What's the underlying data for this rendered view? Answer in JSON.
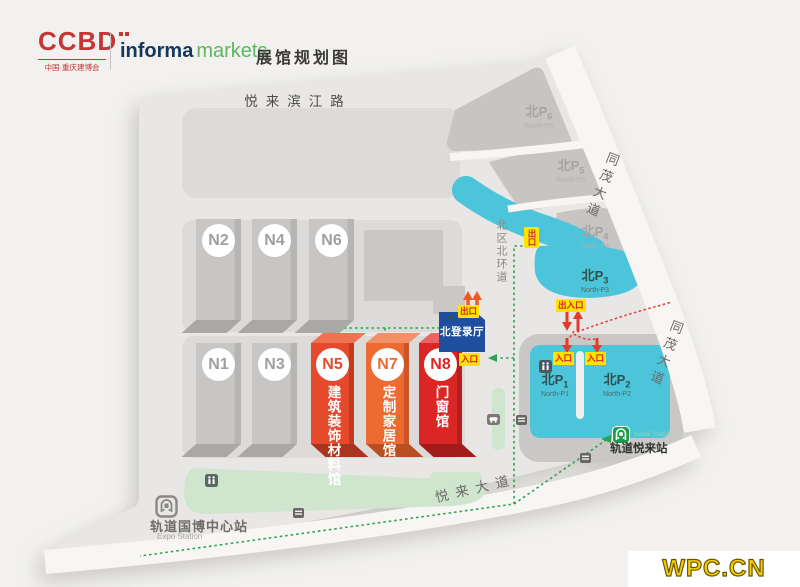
{
  "header": {
    "ccbd": "CCBD",
    "ccbd_sub": "中国·重庆建博会",
    "informa": "informa",
    "markets": "markets",
    "title": "展馆规划图"
  },
  "roads": {
    "riverside": "悦来滨江路",
    "tongmao": "同茂大道",
    "yuelai": "悦来大道",
    "north_ring": "北区北环道"
  },
  "halls": {
    "gray": [
      {
        "id": "N2"
      },
      {
        "id": "N4"
      },
      {
        "id": "N6"
      },
      {
        "id": "N1"
      },
      {
        "id": "N3"
      }
    ],
    "featured": [
      {
        "id": "N5",
        "cols": [
          "建筑装饰",
          "材料馆"
        ]
      },
      {
        "id": "N7",
        "cols": [
          "定制",
          "家居馆"
        ]
      },
      {
        "id": "N8",
        "cols": [
          "门窗馆"
        ]
      }
    ]
  },
  "login_hall": "北登录厅",
  "gates": {
    "exit": "出口",
    "entry": "入口",
    "both": "出入口"
  },
  "parkings": [
    {
      "zh": "北P",
      "num": "6",
      "en": "North-P6"
    },
    {
      "zh": "北P",
      "num": "5",
      "en": "North-P5"
    },
    {
      "zh": "北P",
      "num": "4",
      "en": "North-P4"
    },
    {
      "zh": "北P",
      "num": "3",
      "en": "North-P3"
    },
    {
      "zh": "北P",
      "num": "1",
      "en": "North-P1"
    },
    {
      "zh": "北P",
      "num": "2",
      "en": "North-P2"
    }
  ],
  "stations": {
    "expo": {
      "zh": "轨道国博中心站",
      "en": "Expo Station"
    },
    "yuelai": {
      "zh": "轨道悦来站",
      "en": "Yuelai Station"
    }
  },
  "watermark": "WPC.CN",
  "colors": {
    "cyan_parking": "#4cc4da",
    "red_hall": "#e7492c",
    "orange_hall": "#ed6a31",
    "deep_red_hall": "#da2726",
    "login_blue": "#1e4e9d",
    "gate_yellow": "#ffe400",
    "route_green": "#2aa351",
    "route_red": "#e23b2e"
  }
}
